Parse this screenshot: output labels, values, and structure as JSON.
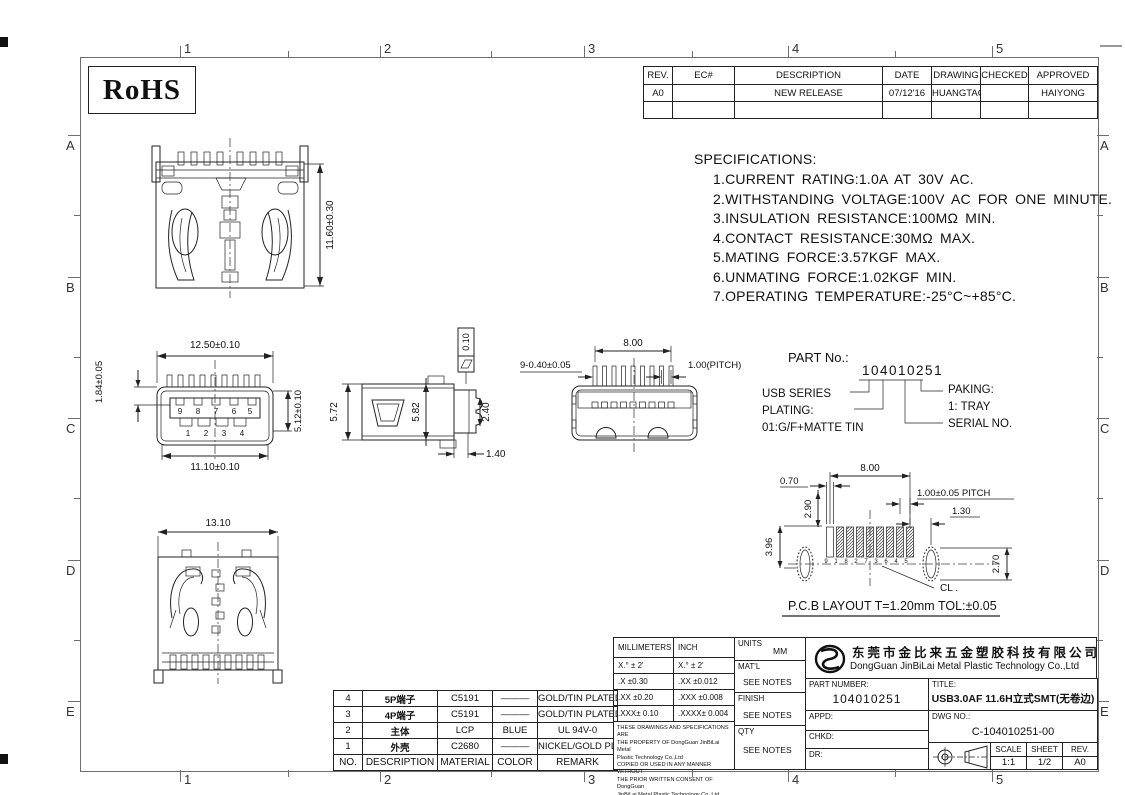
{
  "sheet": {
    "rohs": "RoHS",
    "cols": [
      "1",
      "2",
      "3",
      "4",
      "5"
    ],
    "rows": [
      "A",
      "B",
      "C",
      "D",
      "E"
    ]
  },
  "rev": {
    "h": [
      "REV.",
      "EC#",
      "DESCRIPTION",
      "DATE",
      "DRAWING",
      "CHECKED",
      "APPROVED"
    ],
    "r": [
      "A0",
      "",
      "NEW RELEASE",
      "07/12'16",
      "HUANGTAO",
      "",
      "HAIYONG"
    ]
  },
  "specs": {
    "title": "SPECIFICATIONS:",
    "items": [
      "1.CURRENT RATING:1.0A AT 30V AC.",
      "2.WITHSTANDING VOLTAGE:100V AC FOR ONE MINUTE.",
      "3.INSULATION RESISTANCE:100MΩ MIN.",
      "4.CONTACT RESISTANCE:30MΩ MAX.",
      "5.MATING FORCE:3.57KGF MAX.",
      "6.UNMATING FORCE:1.02KGF MIN.",
      "7.OPERATING TEMPERATURE:-25°C~+85°C."
    ]
  },
  "partno": {
    "label": "PART No.:",
    "number": "104010251",
    "usb": "USB SERIES",
    "plating_label": "PLATING:",
    "plating": "01:G/F+MATTE TIN",
    "paking_label": "PAKING:",
    "paking": "1: TRAY",
    "serial": "SERIAL NO."
  },
  "views": {
    "front": {
      "h": "11.60±0.30"
    },
    "mating": {
      "top": "12.50±0.10",
      "left": "1.84±0.05",
      "right": "5.12±0.10",
      "bottom": "11.10±0.10",
      "pins_top": [
        "9",
        "8",
        "7",
        "6",
        "5"
      ],
      "pins_bottom": [
        "1",
        "2",
        "3",
        "4"
      ]
    },
    "side": {
      "a": "5.72",
      "b": "5.82",
      "c": "2.40",
      "d": "1.40",
      "flat": "0.10"
    },
    "top": {
      "pins": "9-0.40±0.05",
      "span": "8.00",
      "pitch": "1.00(PITCH)"
    },
    "back": {
      "w": "13.10"
    },
    "pcb": {
      "d1": "0.70",
      "d2": "8.00",
      "d3": "2.90",
      "d4": "1.00±0.05 PITCH",
      "d5": "1.30",
      "d6": "3.96",
      "d7": "2.70",
      "cl": "CL .",
      "pins": [
        "9",
        "1",
        "8",
        "2",
        "7",
        "3",
        "6",
        "4",
        "5"
      ],
      "caption": "P.C.B  LAYOUT T=1.20mm TOL:±0.05"
    }
  },
  "material": {
    "headers": [
      "NO.",
      "DESCRIPTION",
      "MATERIAL",
      "COLOR",
      "REMARK"
    ],
    "rows": [
      [
        "4",
        "5P端子",
        "C5191",
        "———",
        "GOLD/TIN PLATED"
      ],
      [
        "3",
        "4P端子",
        "C5191",
        "———",
        "GOLD/TIN PLATED"
      ],
      [
        "2",
        "主体",
        "LCP",
        "BLUE",
        "UL 94V-0"
      ],
      [
        "1",
        "外壳",
        "C2680",
        "———",
        "NICKEL/GOLD PLATED"
      ]
    ]
  },
  "tol": {
    "mm": "MILLIMETERS",
    "inch": "INCH",
    "rows": [
      [
        "X.° ± 2'",
        "X.° ± 2'"
      ],
      [
        ".X  ±0.30",
        ".XX  ±0.012"
      ],
      [
        ".XX ±0.20",
        ".XXX ±0.008"
      ],
      [
        ".XXX± 0.10",
        ".XXXX± 0.004"
      ]
    ],
    "notice": [
      "THESE DRAWINGS AND SPECIFICATIONS ARE",
      "THE PROPERTY OF DongGuan JinBiLai Metal",
      "Plastic Technology Co.,Ltd",
      "COPIED OR USED IN ANY MANNER WITHOUT",
      "THE PRIOR WRITTEN CONSENT OF DongGuan",
      "JinBiLai Metal Plastic Technology Co.,Ltd"
    ]
  },
  "info": {
    "units_l": "UNITS",
    "units_v": "MM",
    "matl_l": "MAT'L",
    "matl_v": "SEE NOTES",
    "finish_l": "FINISH",
    "finish_v": "SEE NOTES",
    "qty_l": "QTY",
    "qty_v": "SEE NOTES"
  },
  "tb": {
    "cn": "东莞市金比来五金塑胶科技有限公司",
    "en": "DongGuan JinBiLai Metal Plastic Technology Co.,Ltd",
    "pn_l": "PART NUMBER:",
    "pn": "104010251",
    "title_l": "TITLE:",
    "title": "USB3.0AF 11.6H立式SMT(无卷边)",
    "appd": "APPD:",
    "chkd": "CHKD:",
    "dr": "DR:",
    "dwg_l": "DWG NO.:",
    "dwg": "C-104010251-00",
    "scale_l": "SCALE",
    "scale": "1:1",
    "sheet_l": "SHEET",
    "sheet": "1/2",
    "rev_l": "REV.",
    "rev": "A0"
  }
}
